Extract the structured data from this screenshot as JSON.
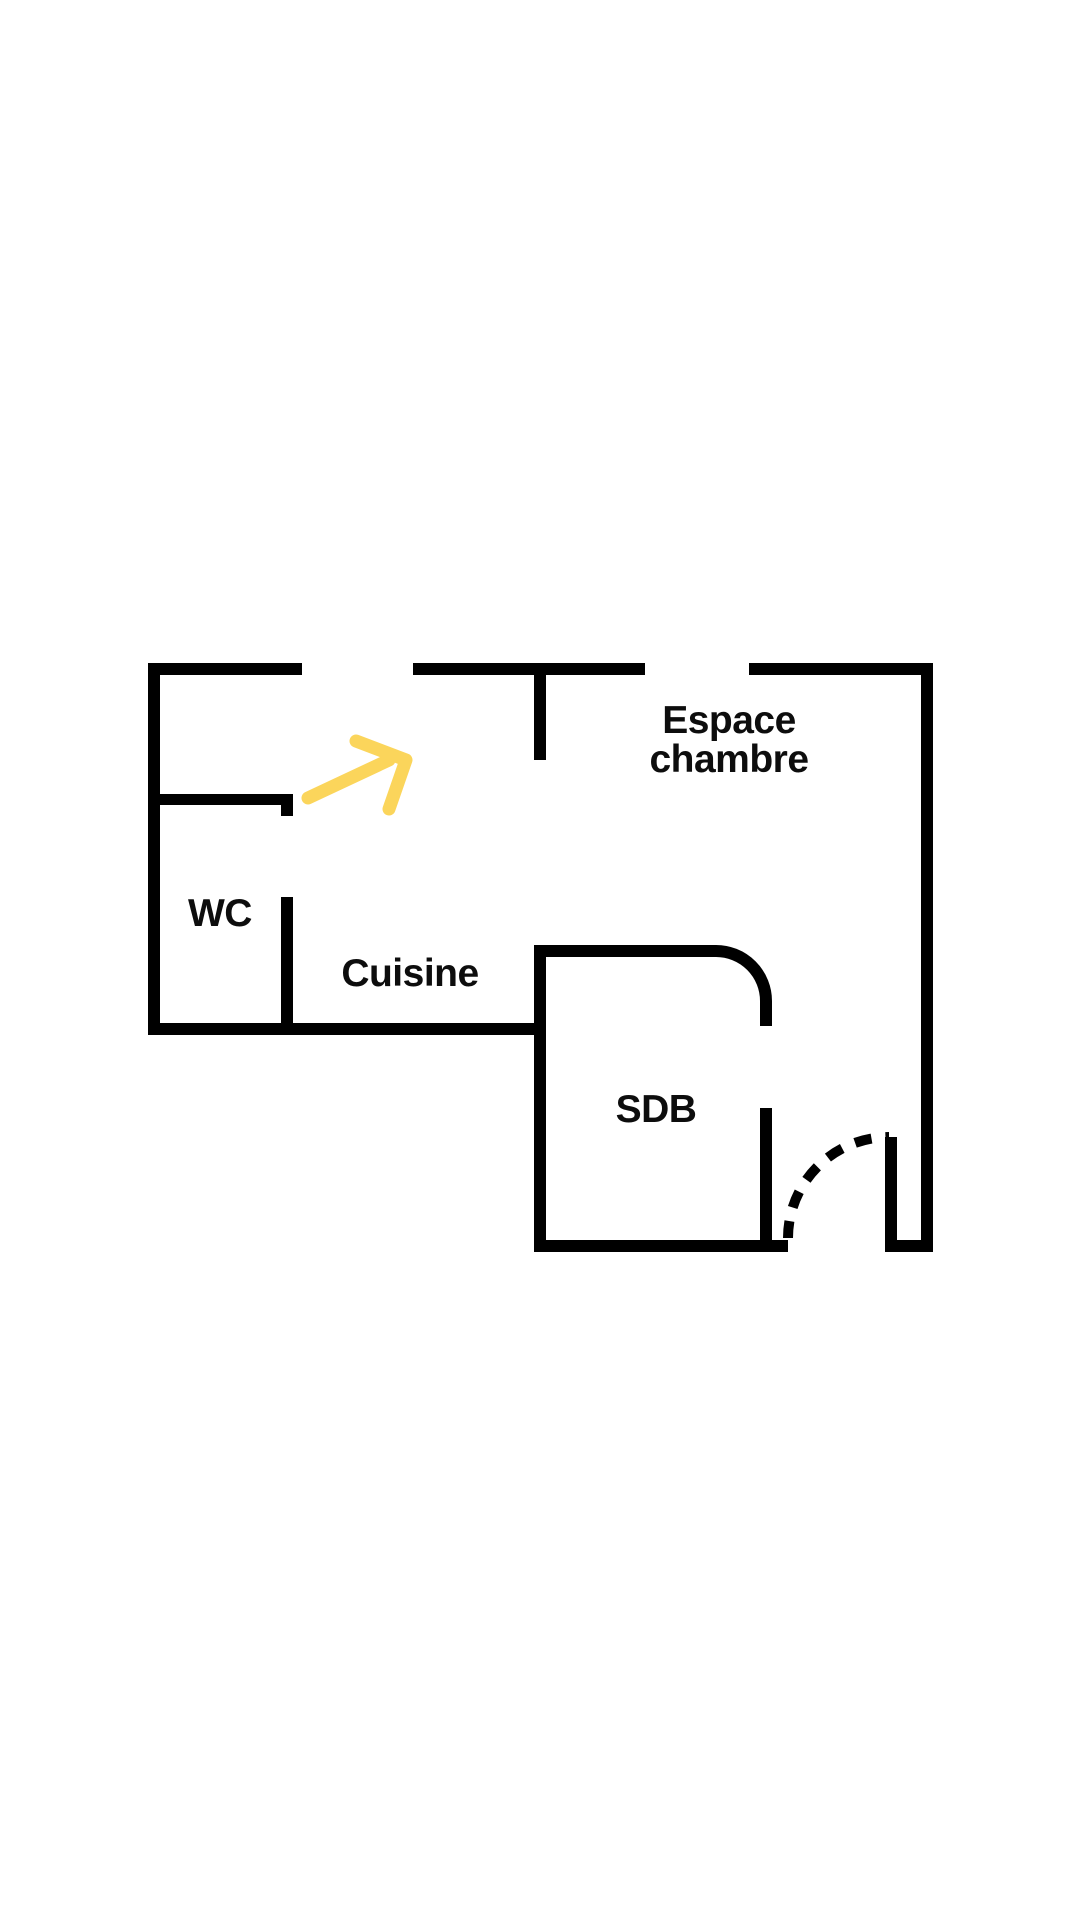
{
  "page": {
    "background_color": "#ffffff"
  },
  "floor_plan": {
    "type": "apartment-floor-plan",
    "wall_color": "#000000",
    "label_color": "#0d0d0d",
    "arrow_color": "#fbd55b",
    "labels": {
      "bedroom_line1": "Espace",
      "bedroom_line2": "chambre",
      "wc": "WC",
      "kitchen": "Cuisine",
      "bathroom": "SDB"
    }
  }
}
